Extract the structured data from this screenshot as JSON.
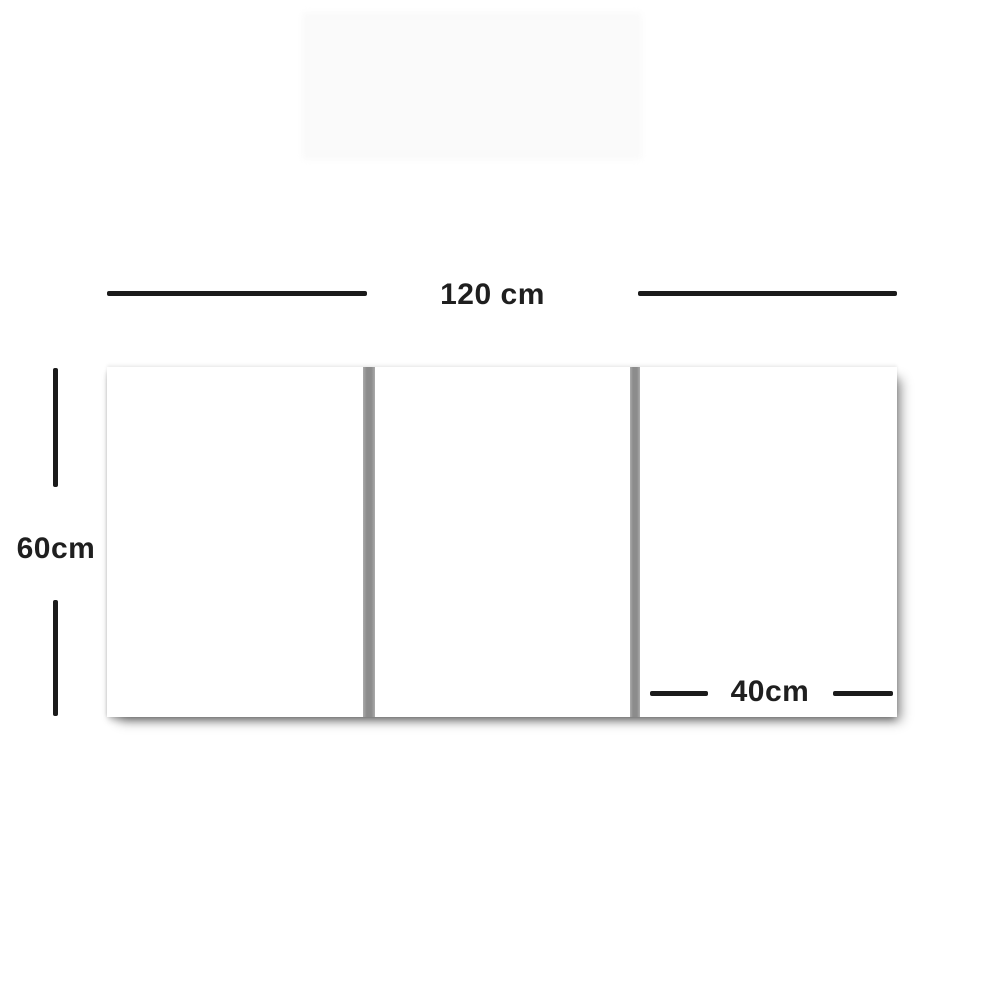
{
  "canvas": {
    "width_px": 1000,
    "height_px": 1000,
    "background": "#ffffff"
  },
  "labels": {
    "total_width": "120 cm",
    "height": "60cm",
    "panel_width": "40cm"
  },
  "panels": {
    "count": 3,
    "fill": "#ffffff",
    "gap_count": 2
  },
  "colors": {
    "dimension_line": "#1b1b1b",
    "label_text": "#1f1f1f",
    "panel_gap": "#8c8c8c",
    "panel_fill": "#ffffff",
    "page_bg": "#ffffff"
  }
}
